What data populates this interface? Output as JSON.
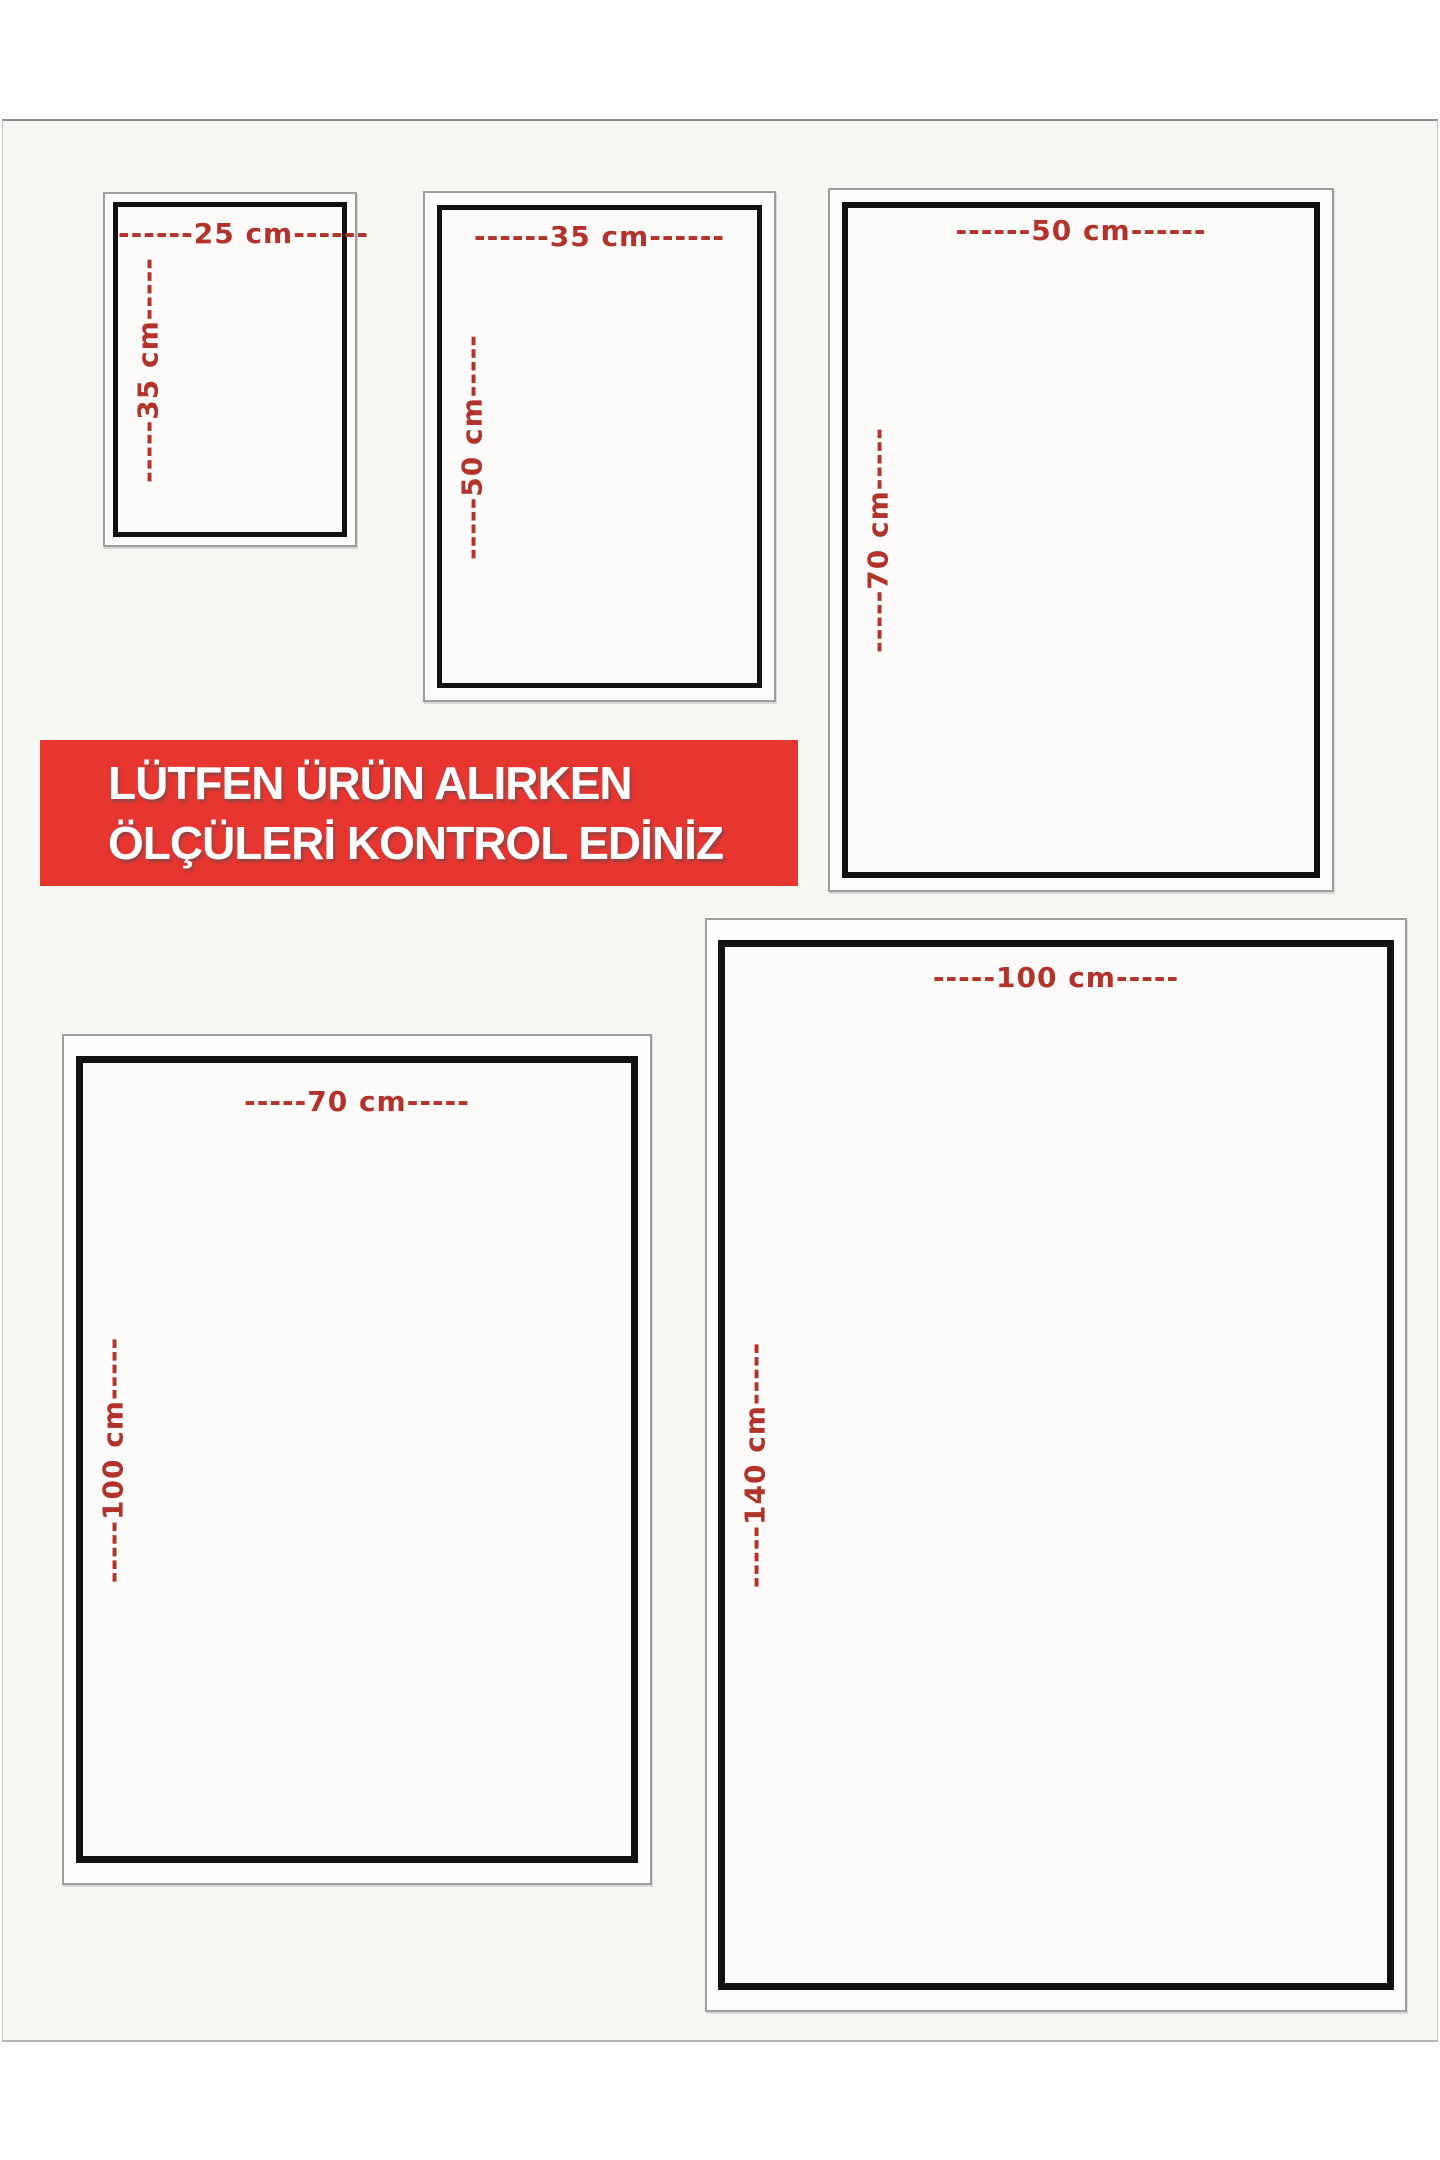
{
  "notice_banner": {
    "line1": "LÜTFEN ÜRÜN ALIRKEN",
    "line2": "ÖLÇÜLERİ KONTROL EDİNİZ",
    "background_color": "#e73530",
    "text_color": "#ffffff"
  },
  "colors": {
    "dimension_label": "#b1332c",
    "inner_frame_border": "#121212",
    "outer_frame_border": "#9e9e9c",
    "sheet_background": "#f8f7f4"
  },
  "size_boxes": [
    {
      "id": "25x35",
      "width_cm": 25,
      "height_cm": 35,
      "width_label": "------25 cm------",
      "height_label": "-----35 cm-----"
    },
    {
      "id": "35x50",
      "width_cm": 35,
      "height_cm": 50,
      "width_label": "------35 cm------",
      "height_label": "-----50 cm-----"
    },
    {
      "id": "50x70",
      "width_cm": 50,
      "height_cm": 70,
      "width_label": "------50 cm------",
      "height_label": "-----70 cm-----"
    },
    {
      "id": "70x100",
      "width_cm": 70,
      "height_cm": 100,
      "width_label": "-----70 cm-----",
      "height_label": "-----100 cm-----"
    },
    {
      "id": "100x140",
      "width_cm": 100,
      "height_cm": 140,
      "width_label": "-----100 cm-----",
      "height_label": "-----140 cm-----"
    }
  ]
}
